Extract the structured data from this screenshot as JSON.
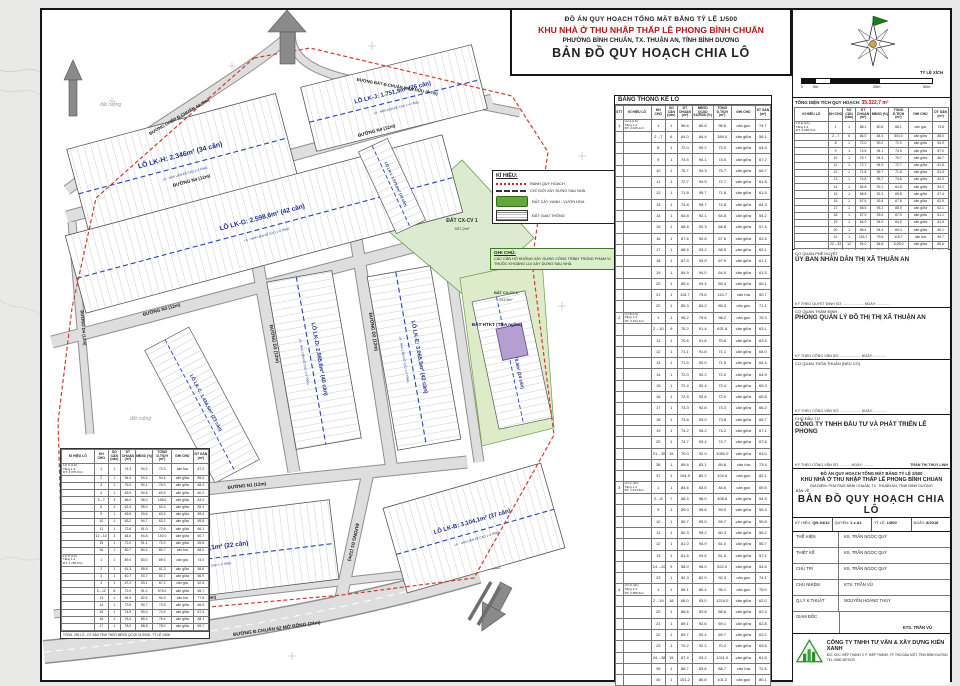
{
  "title_block": {
    "line1": "ĐỒ ÁN QUY HOẠCH TỔNG MẶT BẰNG TỶ LỆ 1/500",
    "line2": "KHU NHÀ Ở THU NHẬP THẤP LÊ PHONG BÌNH CHUẨN",
    "line3": "PHƯỜNG BÌNH CHUẨN, TX. THUẬN AN, TỈNH BÌNH DƯƠNG",
    "line4": "BẢN ĐỒ QUY HOẠCH CHIA LÔ"
  },
  "compass": {
    "scale_title": "TỶ LỆ XÍCH",
    "ticks": [
      "0",
      "5m",
      "25m",
      "50m"
    ]
  },
  "right_panel": {
    "total_area_label": "TỔNG DIỆN TÍCH QUY HOẠCH:",
    "total_area_value": "35.322,7 m²",
    "table": {
      "headers": [
        "KÍ HIỆU LÔ",
        "KH CHO",
        "SỐ CĂN (căn)",
        "DT CHUẨN (m²)",
        "MĐXD (%)",
        "TỔNG D.TÍCH (m²)",
        "GHI CHÚ",
        "DT SÀN (m²)"
      ],
      "rows": [
        [
          "LÔ E (LK)\nTầng 1-4\nDT: 3.065,5m²",
          "1",
          "1",
          "88.1",
          "80.8",
          "88.1",
          "căn góc",
          "74.8"
        ],
        [
          "",
          "2→7",
          "6",
          "84.0",
          "84.4",
          "504.0",
          "căn giữa",
          "68.0"
        ],
        [
          "",
          "8",
          "1",
          "72.0",
          "90.2",
          "72.0",
          "căn giữa",
          "64.9"
        ],
        [
          "",
          "9",
          "1",
          "74.5",
          "94.1",
          "74.5",
          "căn giữa",
          "67.0"
        ],
        [
          "",
          "10",
          "1",
          "75.7",
          "94.3",
          "75.7",
          "căn giữa",
          "66.7"
        ],
        [
          "",
          "11",
          "1",
          "72.7",
          "94.9",
          "72.7",
          "căn giữa",
          "61.8"
        ],
        [
          "",
          "12",
          "1",
          "71.8",
          "95.7",
          "71.8",
          "căn giữa",
          "61.5"
        ],
        [
          "",
          "13",
          "1",
          "74.8",
          "95.7",
          "74.8",
          "căn giữa",
          "64.3"
        ],
        [
          "",
          "14",
          "1",
          "64.8",
          "92.1",
          "64.8",
          "căn giữa",
          "54.2"
        ],
        [
          "",
          "15",
          "1",
          "68.8",
          "92.3",
          "68.8",
          "căn giữa",
          "57.4"
        ],
        [
          "",
          "16",
          "1",
          "67.6",
          "92.8",
          "67.6",
          "căn giữa",
          "62.5"
        ],
        [
          "",
          "17",
          "1",
          "68.5",
          "93.2",
          "68.5",
          "căn giữa",
          "62.1"
        ],
        [
          "",
          "18",
          "1",
          "67.9",
          "93.5",
          "67.9",
          "căn giữa",
          "61.1"
        ],
        [
          "",
          "19",
          "1",
          "64.9",
          "94.0",
          "64.9",
          "căn giữa",
          "61.5"
        ],
        [
          "",
          "20",
          "1",
          "65.4",
          "94.4",
          "65.4",
          "căn giữa",
          "60.1"
        ],
        [
          "",
          "21",
          "1",
          "115.7",
          "79.6",
          "115.7",
          "căn bìa",
          "90.7"
        ],
        [
          "",
          "22→33",
          "12",
          "94.0",
          "84.8",
          "1128.0",
          "căn giữa",
          "80.6"
        ],
        [
          "",
          "34",
          "1",
          "85.3",
          "84.2",
          "85.3",
          "căn góc",
          "71.1"
        ]
      ]
    },
    "approvals": [
      {
        "label": "CƠ QUAN PHÊ DUYỆT",
        "name": "ỦY BAN NHÂN DÂN THỊ XÃ THUẬN AN",
        "sign": "KÝ THEO QUYẾT ĐỊNH SỐ: .................... NGÀY: ............"
      },
      {
        "label": "CƠ QUAN THẨM ĐỊNH",
        "name": "PHÒNG QUẢN LÝ ĐÔ THỊ THỊ XÃ THUẬN AN",
        "sign": "KÝ THEO CÔNG VĂN SỐ: .................... NGÀY: ............"
      },
      {
        "label": "CƠ QUAN THỎA THUẬN (NẾU CÓ)",
        "name": "",
        "sign": "KÝ THEO CÔNG VĂN SỐ: .................... NGÀY: ............"
      }
    ],
    "investor": {
      "label": "CHỦ ĐẦU TƯ",
      "name": "CÔNG TY TNHH ĐẦU TƯ VÀ PHÁT TRIỂN LÊ PHONG",
      "sign": "KÝ THEO CÔNG VĂN SỐ: .......... NGÀY: ..........",
      "signer": "TRẦN THỊ THÙY LINH"
    },
    "project": {
      "line1": "ĐỒ ÁN QUY HOẠCH TỔNG MẶT BẰNG TỶ LỆ 1/500",
      "line2": "KHU NHÀ Ở THU NHẬP THẤP LÊ PHONG BÌNH CHUẨN",
      "line3": "ĐỊA ĐIỂM: PHƯỜNG BÌNH CHUẨN, TX. THUẬN AN, TỈNH BÌNH DƯƠNG",
      "ban_ve": "BẢN VẼ",
      "drawing": "BẢN ĐỒ QUY HOẠCH CHIA LÔ"
    },
    "meta": [
      {
        "label": "KÝ HIỆU:",
        "value": "QH-04/12"
      },
      {
        "label": "QUYỂN:",
        "value": "1 x A1"
      },
      {
        "label": "TỶ LỆ:",
        "value": "1/500"
      },
      {
        "label": "NGÀY:",
        "value": "8/2018"
      }
    ],
    "staff": [
      {
        "label": "THỂ HIỆN",
        "value": "KS. TRẦN NGỌC QUÝ"
      },
      {
        "label": "THIẾT KẾ",
        "value": "KS. TRẦN NGỌC QUÝ"
      },
      {
        "label": "CHỦ TRÌ",
        "value": "KS. TRẦN NGỌC QUÝ"
      },
      {
        "label": "CHỦ NHIỆM",
        "value": "KTS. TRẦN VŨ"
      },
      {
        "label": "Q.LÝ K.THUẬT",
        "value": "NGUYỄN HOÀNG THÙY"
      }
    ],
    "director_label": "GIÁM ĐỐC",
    "director_sign": "KTS. TRẦN VŨ",
    "company": {
      "name": "CÔNG TY TNHH TƯ VẤN & XÂY DỰNG KIẾN XANH",
      "address": "Đ/C: KDC HIỆP THÀNH 3, P. HIỆP THÀNH, TP. THỦ DẦU MỘT, TỈNH BÌNH DƯƠNG",
      "tel": "TEL: 0650.3871929"
    }
  },
  "stats_table": {
    "title": "BẢNG THỐNG KÊ LÔ",
    "headers": [
      "STT",
      "KÍ HIỆU LÔ",
      "KH CHO",
      "SỐ CĂN (căn)",
      "DT CHUẨN (m²)",
      "MĐXD QCXD 01/2008 (%)",
      "TỔNG D.TÍCH (m²)",
      "GHI CHÚ",
      "DT SÀN (m²)"
    ],
    "rows": [
      [
        "1",
        "LÔ A (LK)\nTầng 1-4\nDT: 2.046,1m²",
        "1",
        "1",
        "96.6",
        "80.8",
        "96.6",
        "căn góc",
        "74.7"
      ],
      [
        "",
        "",
        "2→7",
        "6",
        "64.0",
        "84.4",
        "384.0",
        "căn giữa",
        "56.1"
      ],
      [
        "",
        "",
        "8",
        "1",
        "72.0",
        "90.2",
        "72.0",
        "căn giữa",
        "64.9"
      ],
      [
        "",
        "",
        "9",
        "1",
        "74.5",
        "94.1",
        "74.5",
        "căn giữa",
        "67.2"
      ],
      [
        "",
        "",
        "10",
        "1",
        "75.7",
        "94.3",
        "75.7",
        "căn giữa",
        "66.7"
      ],
      [
        "",
        "",
        "11",
        "1",
        "72.7",
        "94.9",
        "72.7",
        "căn giữa",
        "61.8"
      ],
      [
        "",
        "",
        "12",
        "1",
        "71.8",
        "95.7",
        "71.8",
        "căn giữa",
        "61.5"
      ],
      [
        "",
        "",
        "13",
        "1",
        "74.8",
        "95.7",
        "74.8",
        "căn giữa",
        "64.3"
      ],
      [
        "",
        "",
        "14",
        "1",
        "64.8",
        "92.1",
        "64.8",
        "căn giữa",
        "54.2"
      ],
      [
        "",
        "",
        "15",
        "1",
        "68.8",
        "92.3",
        "68.8",
        "căn giữa",
        "57.4"
      ],
      [
        "",
        "",
        "16",
        "1",
        "67.6",
        "92.8",
        "67.6",
        "căn giữa",
        "62.5"
      ],
      [
        "",
        "",
        "17",
        "1",
        "68.5",
        "93.2",
        "68.5",
        "căn giữa",
        "62.1"
      ],
      [
        "",
        "",
        "18",
        "1",
        "67.9",
        "93.5",
        "67.9",
        "căn giữa",
        "61.1"
      ],
      [
        "",
        "",
        "19",
        "1",
        "64.9",
        "94.0",
        "64.9",
        "căn giữa",
        "61.5"
      ],
      [
        "",
        "",
        "20",
        "1",
        "65.4",
        "94.4",
        "65.4",
        "căn giữa",
        "60.1"
      ],
      [
        "",
        "",
        "21",
        "1",
        "115.7",
        "79.6",
        "115.7",
        "căn bìa",
        "90.7"
      ],
      [
        "",
        "",
        "22",
        "1",
        "85.3",
        "84.2",
        "85.3",
        "căn góc",
        "71.1"
      ],
      [
        "2",
        "LÔ B (LK)\nTầng 1-4\nDT: 3.104,1m²",
        "1",
        "1",
        "98.2",
        "79.6",
        "98.2",
        "căn góc",
        "76.3"
      ],
      [
        "",
        "",
        "2→10",
        "9",
        "70.2",
        "91.4",
        "631.8",
        "căn giữa",
        "63.1"
      ],
      [
        "",
        "",
        "11",
        "1",
        "70.6",
        "91.6",
        "70.6",
        "căn giữa",
        "63.5"
      ],
      [
        "",
        "",
        "12",
        "1",
        "71.1",
        "91.8",
        "71.1",
        "căn giữa",
        "64.0"
      ],
      [
        "",
        "",
        "13",
        "1",
        "71.5",
        "92.0",
        "71.5",
        "căn giữa",
        "64.4"
      ],
      [
        "",
        "",
        "14",
        "1",
        "72.0",
        "92.2",
        "72.0",
        "căn giữa",
        "64.9"
      ],
      [
        "",
        "",
        "15",
        "1",
        "72.4",
        "92.4",
        "72.4",
        "căn giữa",
        "65.3"
      ],
      [
        "",
        "",
        "16",
        "1",
        "72.9",
        "92.6",
        "72.9",
        "căn giữa",
        "65.8"
      ],
      [
        "",
        "",
        "17",
        "1",
        "73.3",
        "92.8",
        "73.3",
        "căn giữa",
        "66.2"
      ],
      [
        "",
        "",
        "18",
        "1",
        "73.8",
        "93.0",
        "73.8",
        "căn giữa",
        "66.7"
      ],
      [
        "",
        "",
        "19",
        "1",
        "74.2",
        "93.2",
        "74.2",
        "căn giữa",
        "67.1"
      ],
      [
        "",
        "",
        "20",
        "1",
        "74.7",
        "93.4",
        "74.7",
        "căn giữa",
        "67.6"
      ],
      [
        "",
        "",
        "21→35",
        "15",
        "70.0",
        "92.0",
        "1050.0",
        "căn giữa",
        "63.0"
      ],
      [
        "",
        "",
        "36",
        "1",
        "89.6",
        "83.1",
        "89.6",
        "căn bìa",
        "73.4"
      ],
      [
        "",
        "",
        "37",
        "1",
        "104.9",
        "80.2",
        "104.9",
        "căn góc",
        "82.1"
      ],
      [
        "3",
        "LÔ C (LK)\nTầng 1-4\nDT: 1.434,5m²",
        "1",
        "1",
        "84.6",
        "83.5",
        "84.6",
        "căn góc",
        "69.5"
      ],
      [
        "",
        "",
        "2→8",
        "7",
        "58.4",
        "96.0",
        "408.8",
        "căn giữa",
        "54.9"
      ],
      [
        "",
        "",
        "9",
        "1",
        "59.0",
        "95.8",
        "59.0",
        "căn giữa",
        "55.3"
      ],
      [
        "",
        "",
        "10",
        "1",
        "59.7",
        "95.5",
        "59.7",
        "căn giữa",
        "55.8"
      ],
      [
        "",
        "",
        "11",
        "1",
        "60.3",
        "95.2",
        "60.3",
        "căn giữa",
        "56.2"
      ],
      [
        "",
        "",
        "12",
        "1",
        "61.0",
        "94.9",
        "61.0",
        "căn giữa",
        "56.7"
      ],
      [
        "",
        "",
        "13",
        "1",
        "61.6",
        "94.6",
        "61.6",
        "căn giữa",
        "57.1"
      ],
      [
        "",
        "",
        "14→22",
        "9",
        "58.0",
        "96.0",
        "522.0",
        "căn giữa",
        "54.6"
      ],
      [
        "",
        "",
        "23",
        "1",
        "92.3",
        "82.0",
        "92.3",
        "căn góc",
        "74.1"
      ],
      [
        "4",
        "LÔ D (LK)\nTầng 1-4\nDT: 2.985,6m²",
        "1",
        "1",
        "95.1",
        "80.4",
        "95.1",
        "căn góc",
        "75.0"
      ],
      [
        "",
        "",
        "2→19",
        "18",
        "68.0",
        "93.0",
        "1224.0",
        "căn giữa",
        "62.0"
      ],
      [
        "",
        "",
        "20",
        "1",
        "68.6",
        "92.8",
        "68.6",
        "căn giữa",
        "62.4"
      ],
      [
        "",
        "",
        "21",
        "1",
        "69.1",
        "92.6",
        "69.1",
        "căn giữa",
        "62.8"
      ],
      [
        "",
        "",
        "22",
        "1",
        "69.7",
        "92.4",
        "69.7",
        "căn giữa",
        "63.2"
      ],
      [
        "",
        "",
        "23",
        "1",
        "70.2",
        "92.2",
        "70.2",
        "căn giữa",
        "63.6"
      ],
      [
        "",
        "",
        "24→38",
        "15",
        "67.4",
        "93.2",
        "1011.0",
        "căn giữa",
        "61.6"
      ],
      [
        "",
        "",
        "39",
        "1",
        "88.7",
        "83.6",
        "88.7",
        "căn bìa",
        "72.6"
      ],
      [
        "",
        "",
        "40",
        "1",
        "101.2",
        "80.8",
        "101.2",
        "căn góc",
        "80.1"
      ]
    ]
  },
  "left_table": {
    "headers": [
      "KÍ HIỆU LÔ",
      "KH CHO",
      "SỐ CĂN (căn)",
      "DT CHUẨN (m²)",
      "MĐXD (%)",
      "TỔNG D.TÍCH (m²)",
      "GHI CHÚ",
      "DT SÀN (m²)"
    ],
    "rows": [
      [
        "LÔ G (LK)\nTầng 1-4\nDT: 3.075,6m²",
        "1",
        "1",
        "74.3",
        "94.2",
        "74.3",
        "căn bìa",
        "67.2"
      ],
      [
        "",
        "2",
        "1",
        "94.4",
        "94.2",
        "94.4",
        "căn giữa",
        "85.0"
      ],
      [
        "",
        "3",
        "1",
        "76.0",
        "90.1",
        "76.0",
        "căn giữa",
        "68.4"
      ],
      [
        "",
        "4",
        "1",
        "63.9",
        "94.5",
        "63.9",
        "căn giữa",
        "60.2"
      ],
      [
        "",
        "5→7",
        "3",
        "66.0",
        "96.0",
        "198.0",
        "căn giữa",
        "63.4"
      ],
      [
        "",
        "8",
        "1",
        "62.4",
        "95.0",
        "62.4",
        "căn giữa",
        "59.3"
      ],
      [
        "",
        "9",
        "1",
        "63.5",
        "93.6",
        "63.5",
        "căn giữa",
        "59.4"
      ],
      [
        "",
        "10",
        "1",
        "63.2",
        "94.7",
        "63.2",
        "căn giữa",
        "59.8"
      ],
      [
        "",
        "11",
        "1",
        "72.6",
        "91.0",
        "72.6",
        "căn giữa",
        "66.1"
      ],
      [
        "",
        "12→14",
        "3",
        "64.0",
        "94.8",
        "192.0",
        "căn giữa",
        "60.7"
      ],
      [
        "",
        "15",
        "1",
        "72.0",
        "91.1",
        "72.0",
        "căn giữa",
        "65.6"
      ],
      [
        "",
        "16",
        "1",
        "80.7",
        "84.2",
        "80.7",
        "căn bìa",
        "68.0"
      ],
      [
        "LÔ H (LK)\nTầng 1-4\nDT: 1.782,9m²",
        "1",
        "1",
        "89.0",
        "83.0",
        "89.0",
        "căn góc",
        "74.0"
      ],
      [
        "",
        "2",
        "1",
        "61.3",
        "95.6",
        "61.3",
        "căn giữa",
        "58.6"
      ],
      [
        "",
        "3",
        "1",
        "60.7",
        "93.7",
        "60.7",
        "căn giữa",
        "56.9"
      ],
      [
        "",
        "4",
        "1",
        "67.2",
        "93.1",
        "67.2",
        "căn góc",
        "62.6"
      ],
      [
        "",
        "5→12",
        "8",
        "72.0",
        "91.2",
        "576.0",
        "căn giữa",
        "65.7"
      ],
      [
        "",
        "13",
        "1",
        "94.9",
        "82.4",
        "94.9",
        "căn bìa",
        "77.6"
      ],
      [
        "",
        "14",
        "1",
        "73.5",
        "90.7",
        "73.5",
        "căn giữa",
        "66.5"
      ],
      [
        "",
        "15",
        "1",
        "74.9",
        "90.0",
        "74.9",
        "căn giữa",
        "67.4"
      ],
      [
        "",
        "16",
        "1",
        "76.4",
        "89.4",
        "76.4",
        "căn giữa",
        "68.1"
      ],
      [
        "",
        "17",
        "1",
        "78.0",
        "88.8",
        "78.0",
        "căn giữa",
        "69.7"
      ]
    ],
    "note": "TỔNG: 294 LÔ - DT SÀN TÍNH THEO MĐXD QCXD 01/2008 - TỶ LỆ 1/500"
  },
  "legend": {
    "title": "KÍ HIỆU:",
    "items": [
      {
        "swatch": "red-dash",
        "label": "RANH QUY HOẠCH"
      },
      {
        "swatch": "dark-dash",
        "label": "CHỈ GIỚI XÂY DỰNG SAU NHÀ"
      },
      {
        "swatch": "green",
        "label": "ĐẤT CÂY XANH - VƯỜN HOA"
      },
      {
        "swatch": "hatch",
        "label": "ĐẤT GIAO THÔNG"
      }
    ]
  },
  "note_box": {
    "title": "GHI CHÚ:",
    "text": "CÁC CĂN HỘ KHÔNG XÂY DỰNG CÔNG TRÌNH TRONG PHẠM VI THUỘC KHOẢNG LÙI XÂY DỰNG SAU NHÀ."
  },
  "map": {
    "block_note": "LK - NHÀ LIÊN KẾ CAO 1-4 TẦNG",
    "blocks": {
      "lk_h": "LÔ LK-H: 2.346m² (34 căn)",
      "lk_j": "LÔ LK-J: 1.751,9m² (26 căn)",
      "lk_g": "LÔ LK-G: 2.598,6m² (42 căn)",
      "lk_i": "LÔ LK-I: 1.070,6m² (15 căn)",
      "lk_d": "LÔ LK-D: 2.985,6m² (40 căn)",
      "lk_e": "LÔ LK-E: 3.065,5m² (42 căn)",
      "lk_f": "LÔ LK-F: 1.770,4m² (24 căn)",
      "lk_c": "LÔ LK-C: 1.434,5m² (23 căn)",
      "lk_a": "LÔ LK-A: 2.046,1m² (22 căn)",
      "lk_b": "LÔ LK-B: 3.104,1m² (37 căn)"
    },
    "roads": {
      "n4": "ĐƯỜNG N4 (12m)",
      "n3": "ĐƯỜNG N3 (12m)",
      "n1": "ĐƯỜNG N1 (12m)",
      "d1": "ĐƯỜNG D1 (12m)",
      "d2": "ĐƯỜNG D2 (12m)",
      "d3": "ĐƯỜNG D3 (12m)",
      "d4": "ĐƯỜNG D4 (12m)",
      "ghep44": "ĐƯỜNG GHÉP Đ.CHUẨN 44 (9m)",
      "hienhuu": "ĐƯỜNG ĐẤT Đ.CHUẨN HIỆN HỮU (5-7m)",
      "ghep42": "ĐƯỜNG GHÉP B.CHUẨN 42 (9m)",
      "morong": "ĐƯỜNG Đ.CHUẨN 62 MỞ RỘNG (24m)"
    },
    "areas": {
      "cx1": "ĐẤT CX-CV 1",
      "cx1_area": "937,2m²",
      "cx2": "ĐẤT CX-CV 2",
      "cx2_area": "931,5m²",
      "htkt": "ĐẤT HTKT (TBA ngầm)"
    },
    "bg1": "đất ruộng",
    "bg2": "đất ruộng"
  }
}
